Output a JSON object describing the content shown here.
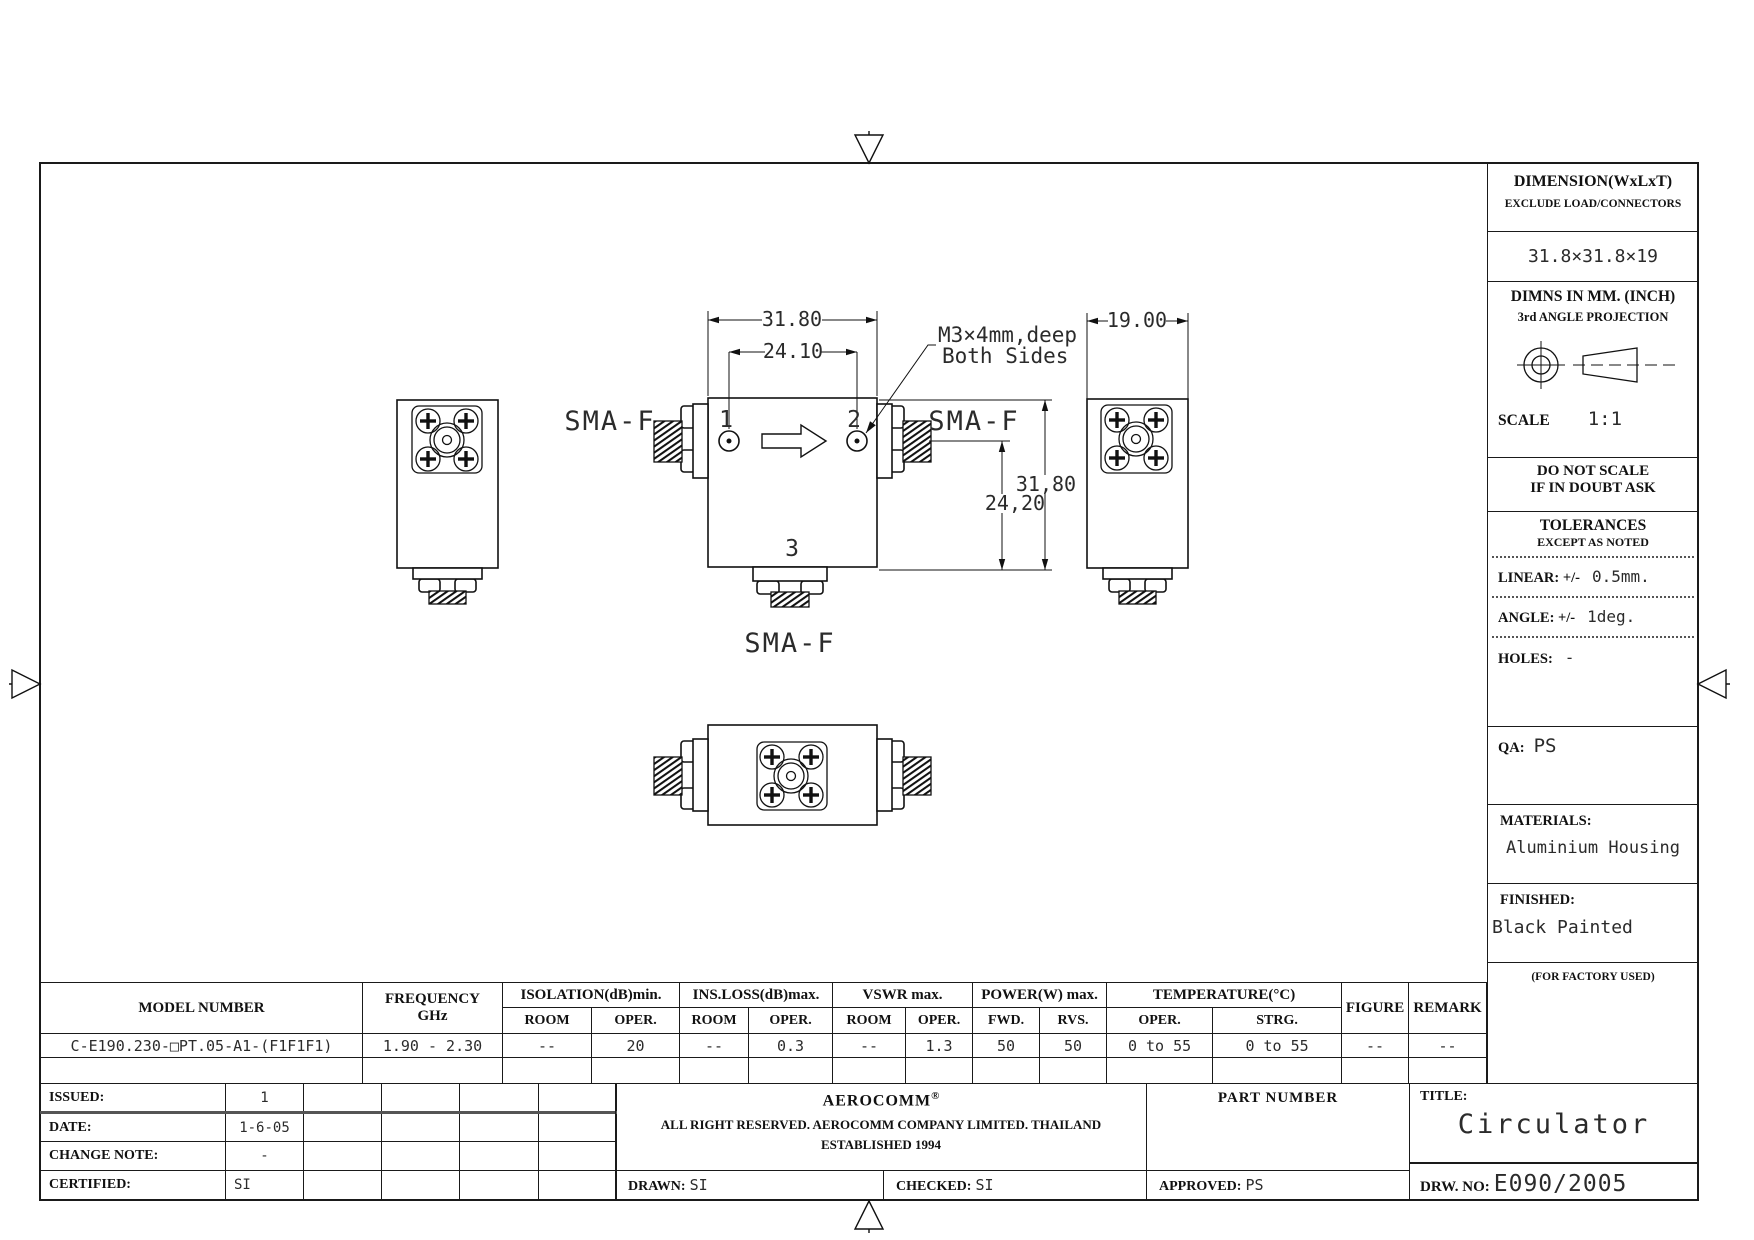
{
  "panel": {
    "dimension_label": "DIMENSION(WxLxT)",
    "dimension_note": "EXCLUDE LOAD/CONNECTORS",
    "dimension_value": "31.8×31.8×19",
    "units_line": "DIMNS IN MM. (INCH)",
    "projection_line": "3rd ANGLE PROJECTION",
    "scale_label": "SCALE",
    "scale_value": "1:1",
    "warning_line1": "DO NOT SCALE",
    "warning_line2": "IF IN DOUBT ASK",
    "tolerances_title": "TOLERANCES",
    "tolerances_sub": "EXCEPT AS NOTED",
    "linear_label": "LINEAR: +/-",
    "linear_value": "0.5mm.",
    "angle_label": "ANGLE: +/-",
    "angle_value": "1deg.",
    "holes_label": "HOLES:",
    "holes_value": "-",
    "qa_label": "QA:",
    "qa_value": "PS",
    "materials_label": "MATERIALS:",
    "materials_value": "Aluminium Housing",
    "finished_label": "FINISHED:",
    "finished_value": "Black Painted",
    "factory_note": "(FOR FACTORY USED)"
  },
  "spec_table": {
    "col_model": "MODEL NUMBER",
    "col_frequency": "FREQUENCY",
    "col_frequency_unit": "GHz",
    "group_isolation": "ISOLATION(dB)min.",
    "group_insloss": "INS.LOSS(dB)max.",
    "group_vswr": "VSWR max.",
    "group_power": "POWER(W) max.",
    "group_temperature": "TEMPERATURE(°C)",
    "col_figure": "FIGURE",
    "col_remark": "REMARK",
    "sub_headers": [
      "ROOM",
      "OPER.",
      "ROOM",
      "OPER.",
      "ROOM",
      "OPER.",
      "FWD.",
      "RVS.",
      "OPER.",
      "STRG."
    ],
    "rows": [
      [
        "C-E190.230-□PT.05-A1-(F1F1F1)",
        "1.90 - 2.30",
        "--",
        "20",
        "--",
        "0.3",
        "--",
        "1.3",
        "50",
        "50",
        "0 to 55",
        "0 to 55",
        "--",
        "--"
      ]
    ]
  },
  "title_block": {
    "revision_rows": [
      {
        "label": "ISSUED:",
        "value": "1"
      },
      {
        "label": "DATE:",
        "value": "1-6-05"
      },
      {
        "label": "CHANGE NOTE:",
        "value": "-"
      },
      {
        "label": "CERTIFIED:",
        "value": "SI"
      }
    ],
    "company": {
      "name": "AEROCOMM",
      "reg_mark": "®",
      "line1": "ALL RIGHT RESERVED. AEROCOMM COMPANY LIMITED. THAILAND",
      "line2": "ESTABLISHED 1994"
    },
    "part_number_label": "PART NUMBER",
    "drawn_label": "DRAWN:",
    "drawn_value": "SI",
    "checked_label": "CHECKED:",
    "checked_value": "SI",
    "approved_label": "APPROVED:",
    "approved_value": "PS",
    "title_label": "TITLE:",
    "title_value": "Circulator",
    "drw_no_label": "DRW. NO:",
    "drw_no_value": "E090/2005"
  },
  "drawing": {
    "labels": {
      "sma_left": "SMA-F",
      "sma_right": "SMA-F",
      "sma_bottom": "SMA-F",
      "port1": "1",
      "port2": "2",
      "port3": "3"
    },
    "dimensions": {
      "body_width": "31.80",
      "hole_spacing": "24.10",
      "body_height": "31,80",
      "hole_to_bottom": "24,20",
      "depth": "19.00"
    },
    "note": {
      "line1": "M3×4mm,deep",
      "line2": "Both Sides"
    }
  }
}
